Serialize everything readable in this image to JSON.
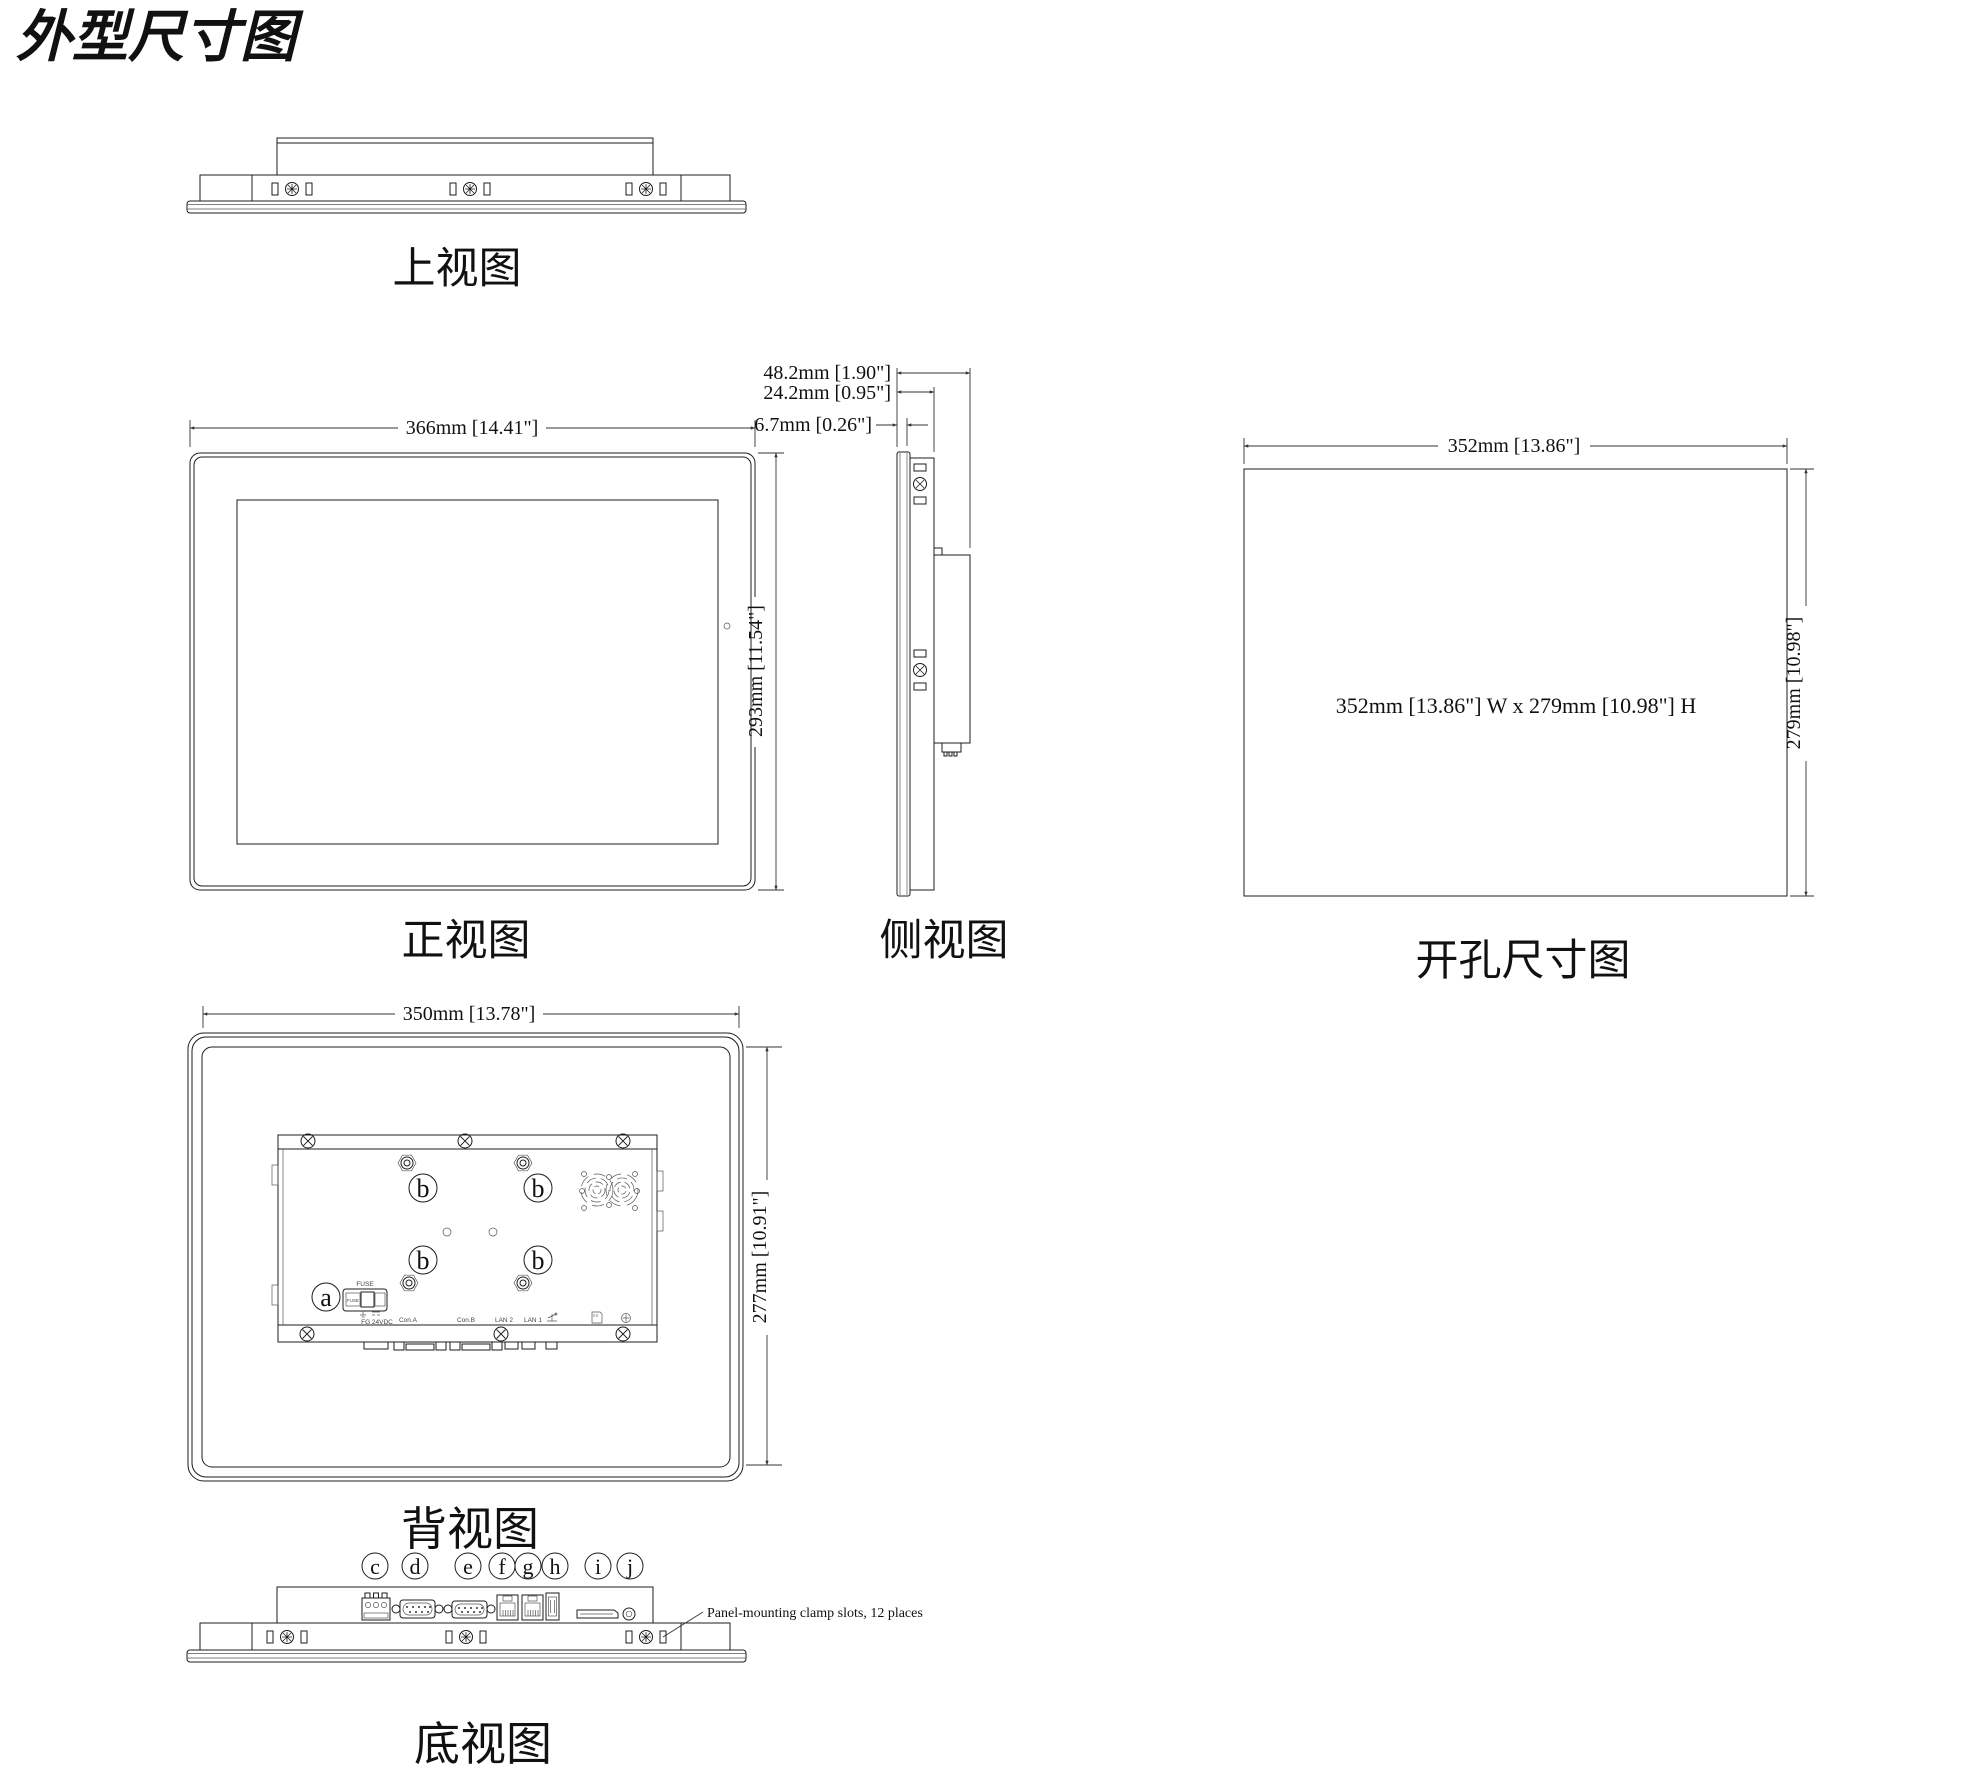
{
  "title": "外型尺寸图",
  "views": {
    "top": {
      "label": "上视图"
    },
    "front": {
      "label": "正视图",
      "dim_width": "366mm [14.41\"]",
      "dim_height": "293mm [11.54\"]"
    },
    "side": {
      "label": "侧视图",
      "dim_depth_total": "48.2mm [1.90\"]",
      "dim_depth_rear": "24.2mm [0.95\"]",
      "dim_bezel": "6.7mm [0.26\"]"
    },
    "cutout": {
      "label": "开孔尺寸图",
      "dim_width": "352mm [13.86\"]",
      "dim_height": "279mm [10.98\"]",
      "center_text": "352mm [13.86\"] W x 279mm [10.98\"] H"
    },
    "rear": {
      "label": "背视图",
      "dim_width": "350mm [13.78\"]",
      "dim_height": "277mm [10.91\"]",
      "callout_a": "a",
      "callout_b": "b",
      "fuse_title": "FUSE",
      "fuse_cell": "FUSE",
      "power_label": "FG  24VDC",
      "ports": [
        "Con.A",
        "Con.B",
        "LAN 2",
        "LAN 1"
      ]
    },
    "bottom": {
      "label": "底视图",
      "callouts": [
        "c",
        "d",
        "e",
        "f",
        "g",
        "h",
        "i",
        "j"
      ],
      "note": "Panel-mounting clamp slots, 12 places"
    }
  }
}
